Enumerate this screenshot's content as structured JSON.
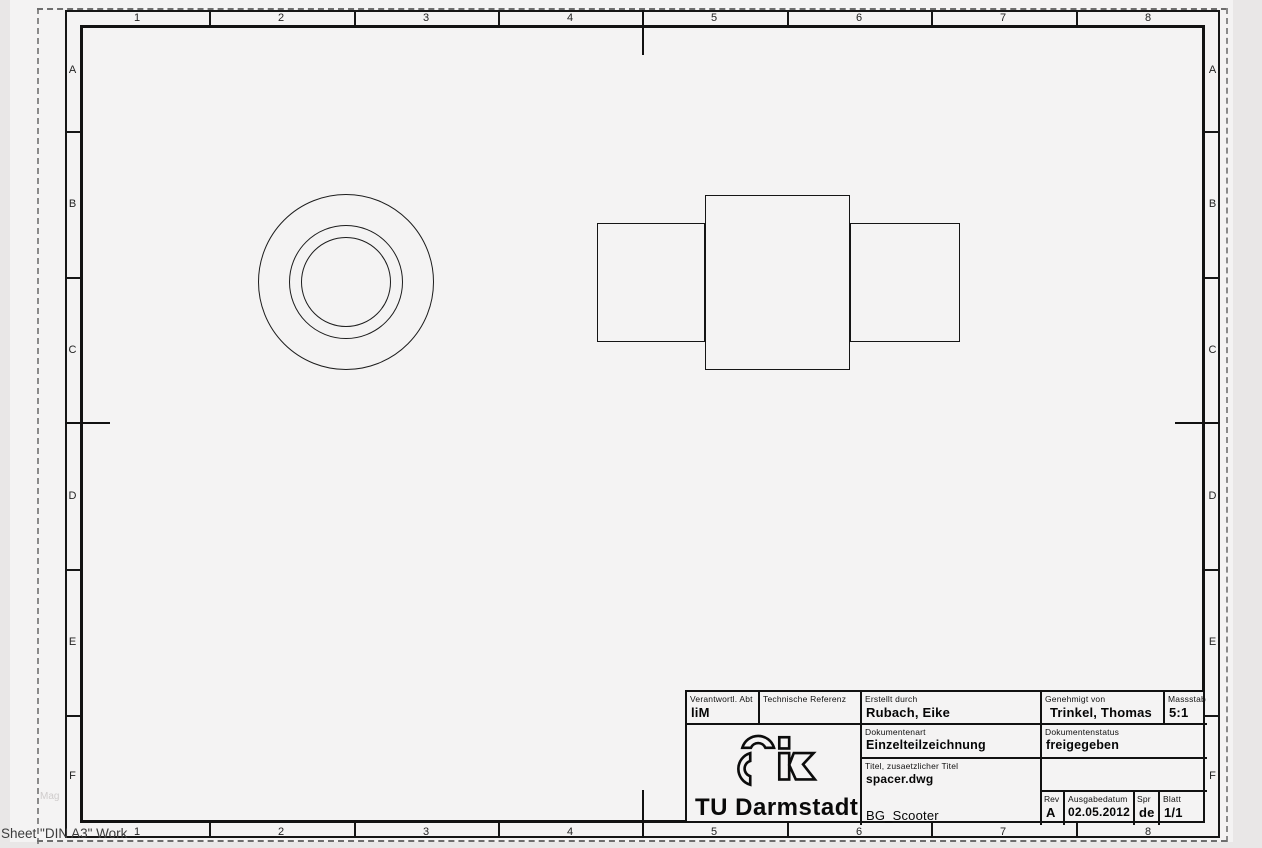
{
  "sheet": {
    "tab_label": "Sheet \"DIN A3\" Work",
    "artifact_text": "Mag"
  },
  "grid": {
    "columns": [
      "1",
      "2",
      "3",
      "4",
      "5",
      "6",
      "7",
      "8"
    ],
    "rows": [
      "A",
      "B",
      "C",
      "D",
      "E",
      "F"
    ]
  },
  "title_block": {
    "verantwortl": {
      "label": "Verantwortl. Abt",
      "value": "liM"
    },
    "referenz": {
      "label": "Technische Referenz",
      "value": ""
    },
    "erstellt": {
      "label": "Erstellt durch",
      "value": "Rubach, Eike"
    },
    "genehmigt": {
      "label": "Genehmigt von",
      "value": "Trinkel, Thomas"
    },
    "massstab": {
      "label": "Massstab",
      "value": "5:1"
    },
    "dokumentenart": {
      "label": "Dokumentenart",
      "value": "Einzelteilzeichnung"
    },
    "dokumentenstatus": {
      "label": "Dokumentenstatus",
      "value": "freigegeben"
    },
    "titel": {
      "label": "Titel, zusaetzlicher Titel",
      "value": "spacer.dwg",
      "project": "BG_Scooter"
    },
    "rev": {
      "label": "Rev",
      "value": "A"
    },
    "datum": {
      "label": "Ausgabedatum",
      "value": "02.05.2012"
    },
    "spr": {
      "label": "Spr",
      "value": "de"
    },
    "blatt": {
      "label": "Blatt",
      "value": "1/1"
    },
    "logo_text": "TU Darmstadt"
  },
  "drawing": {
    "front_view": {
      "cx": 346,
      "cy": 282,
      "radii": [
        88,
        57,
        45
      ]
    },
    "side_view_rects": [
      {
        "x": 597,
        "y": 223,
        "w": 108,
        "h": 119
      },
      {
        "x": 705,
        "y": 195,
        "w": 145,
        "h": 175
      },
      {
        "x": 850,
        "y": 223,
        "w": 110,
        "h": 119
      }
    ]
  },
  "colors": {
    "line": "#161616",
    "paper": "#f4f3f3",
    "outside": "#e9e7e7",
    "dash": "#8a8a8a"
  }
}
